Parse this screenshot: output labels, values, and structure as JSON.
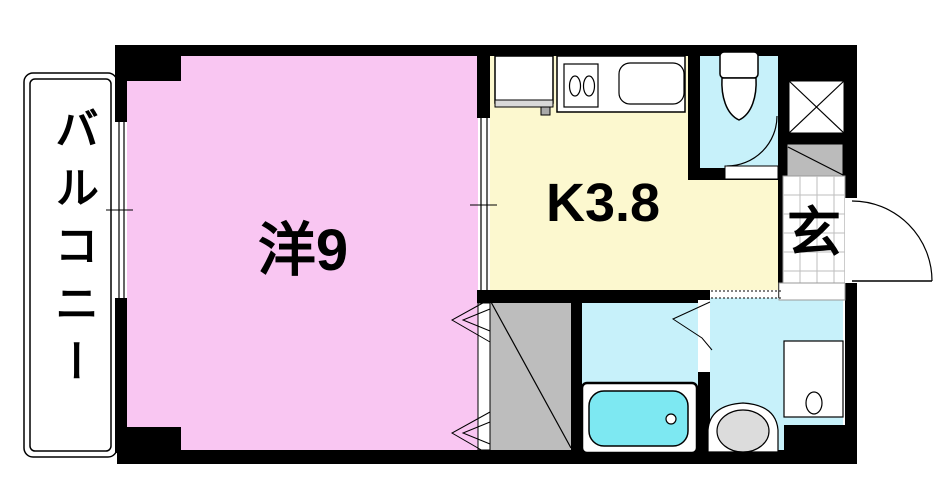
{
  "floorplan": {
    "labels": {
      "balcony": "バルコニー",
      "western_room": "洋9",
      "kitchen": "K3.8",
      "entrance": "玄"
    },
    "colors": {
      "wall": "#000000",
      "western_room": "#f9c6f2",
      "kitchen": "#fcf8cf",
      "wet_area": "#c7f1fa",
      "bathtub": "#7de8f2",
      "closet": "#bdbdbd",
      "fixture_gray": "#dcdcdc",
      "shoe_cabinet": "#bbbbbb"
    }
  }
}
